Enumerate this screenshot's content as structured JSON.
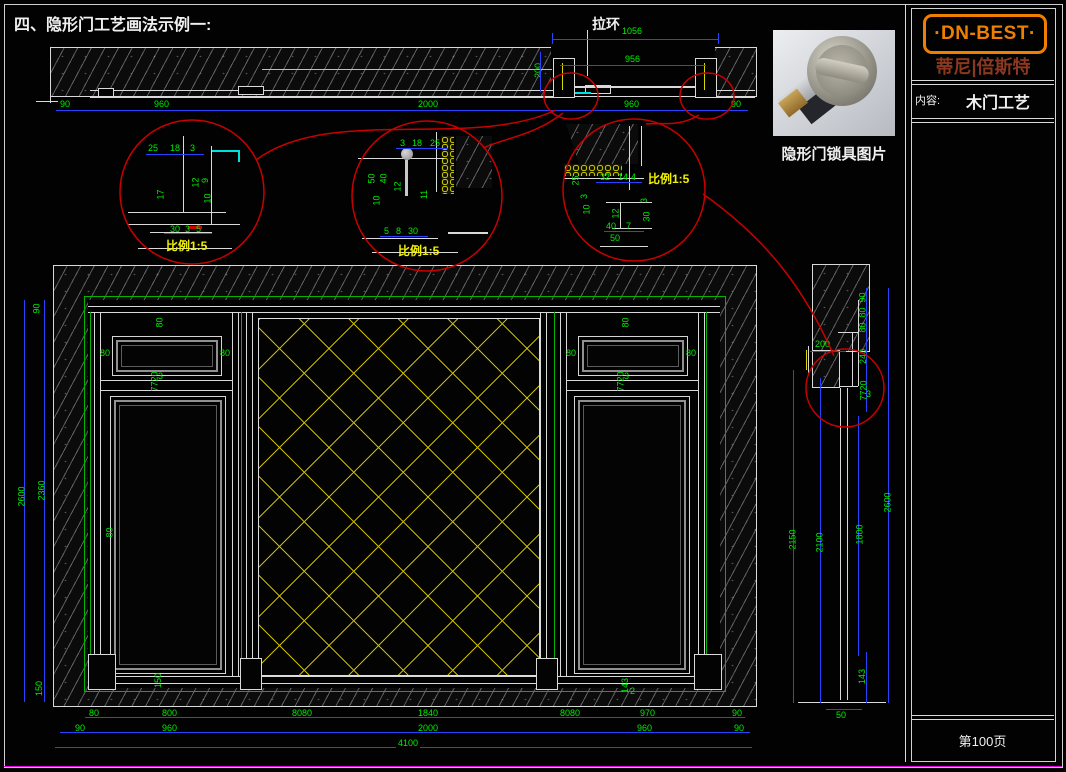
{
  "title": "四、隐形门工艺画法示例一:",
  "top_section": {
    "pull_ring": "拉环",
    "d1056": "1056",
    "d956": "956",
    "d200": "200",
    "row": [
      "90",
      "960",
      "2000",
      "960",
      "90"
    ]
  },
  "detail1": {
    "scale": "比例1:5",
    "top": [
      "25",
      "18",
      "3"
    ],
    "left_v": "17",
    "v": [
      "12",
      "9",
      "10"
    ],
    "bottom": [
      "30",
      "3",
      "5"
    ]
  },
  "detail2": {
    "scale": "比例1:5",
    "top": [
      "3",
      "18",
      "25"
    ],
    "left_v": [
      "50",
      "40",
      "10"
    ],
    "mid": "12",
    "right_v": "11",
    "bottom": [
      "5",
      "8",
      "30"
    ]
  },
  "detail3": {
    "scale": "比例1:5",
    "left_v": "25",
    "top": [
      "32",
      "14",
      "4"
    ],
    "v1": [
      "3",
      "10"
    ],
    "v2": [
      "3",
      "30"
    ],
    "mid": "12",
    "bottom": [
      "40",
      "7",
      "50"
    ]
  },
  "lock_photo": {
    "caption": "隐形门锁具图片"
  },
  "elevation": {
    "side": [
      "2600",
      "90",
      "2360",
      "150"
    ],
    "gap": "80",
    "stile": "80",
    "transom": "7720",
    "tol": "3",
    "plinth_l": "150",
    "plinth_r": "143",
    "tol2": "2",
    "r1": [
      "80",
      "800",
      "8080",
      "1840",
      "8080",
      "970",
      "90"
    ],
    "r2": [
      "90",
      "960",
      "2000",
      "960",
      "90"
    ],
    "r3": "4100"
  },
  "section": {
    "d200": "200",
    "col": [
      "90",
      "80",
      "80",
      "240",
      "7720",
      "3"
    ],
    "tall": [
      "2150",
      "2100",
      "1800",
      "2600"
    ],
    "d143": "143",
    "d50": "50"
  },
  "panel": {
    "logo": "·DN-BEST·",
    "brand": "蒂尼|倍斯特",
    "content_label": "内容:",
    "content": "木门工艺",
    "page": "第100页"
  }
}
